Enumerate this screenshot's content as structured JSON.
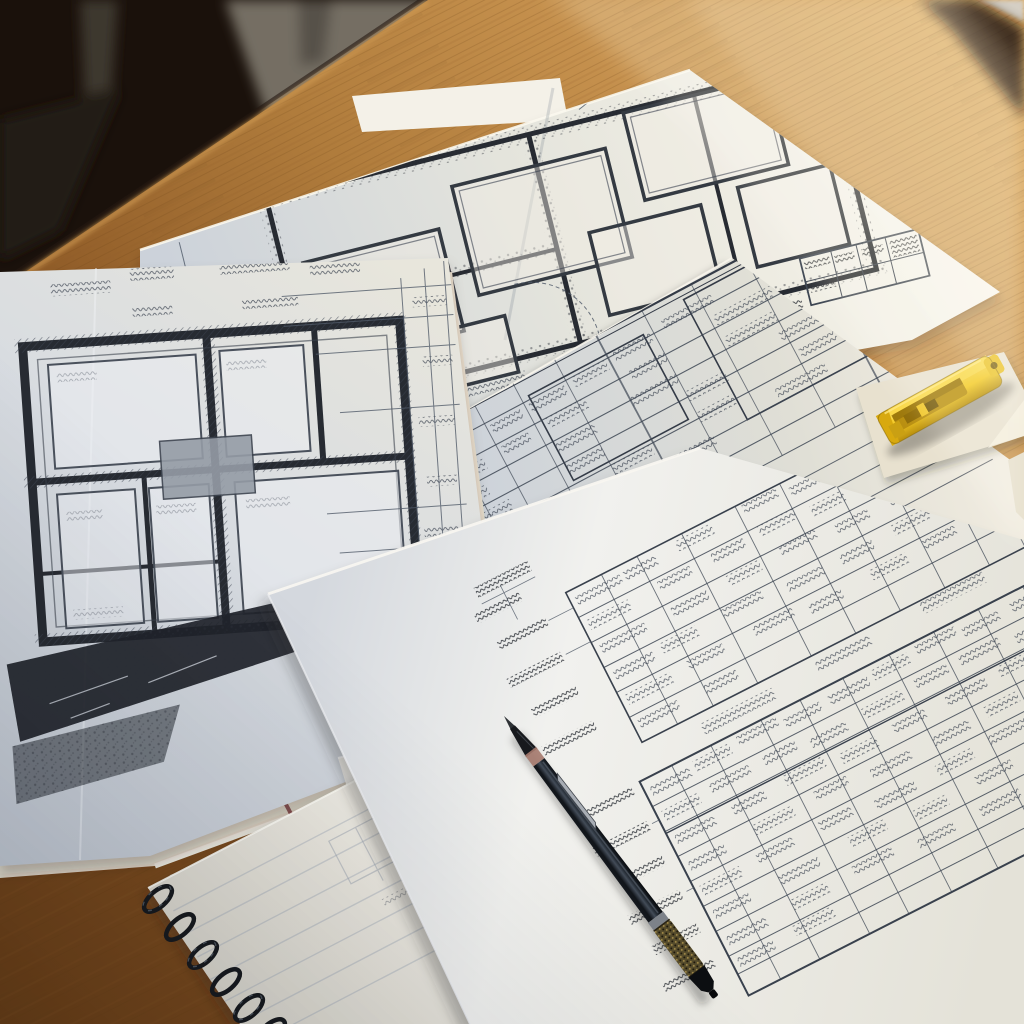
{
  "scene": {
    "setting": "photo-of-architectural-blueprints-on-wooden-desk-in-sunbeam",
    "objects": [
      "wooden-desk-surface",
      "dark-room-background",
      "gray-furniture",
      "top-floorplan-blueprint-sheet",
      "left-floorplan-blueprint-sheet",
      "middle-schedule-sheet",
      "large-bottom-schedule-sheet",
      "cream-paper-stack",
      "paper-strip",
      "yellow-utility-knife",
      "black-clutch-pencil",
      "spiral-notebook",
      "sunbeam"
    ]
  },
  "palette": {
    "room_dark": "#1a110b",
    "furniture_gray": "#756e63",
    "furniture_leg": "#3e382f",
    "wood_dark": "#6b3f18",
    "wood_mid": "#b07c3c",
    "wood_light": "#ddab62",
    "paper_cool": "#ccd2da",
    "paper_mid": "#e8e6dc",
    "paper_warm": "#f5efe2",
    "paper_bright": "#faf6ea",
    "paper_white": "#f1f1ee",
    "paper_cream": "#e8e1cf",
    "ink_dark": "#272b32",
    "ink_mid": "#3d4552",
    "ink_light": "#5a6472",
    "pencil_body": "#14181e",
    "pencil_highlight": "#434c58",
    "pencil_metal": "#a8adb4",
    "pencil_brass": "#564c2c",
    "pencil_collar": "#a67a6e",
    "knife_yellow": "#f3c822",
    "knife_yellow_light": "#f8d64a",
    "knife_yellow_dark": "#b98f0e",
    "knife_recess": "#8f6c08",
    "wire_black": "#171a1f",
    "folder_red": "#7e3d41",
    "beam_warm": "#ffeecd",
    "notebook_line": "#a9b1bb"
  }
}
